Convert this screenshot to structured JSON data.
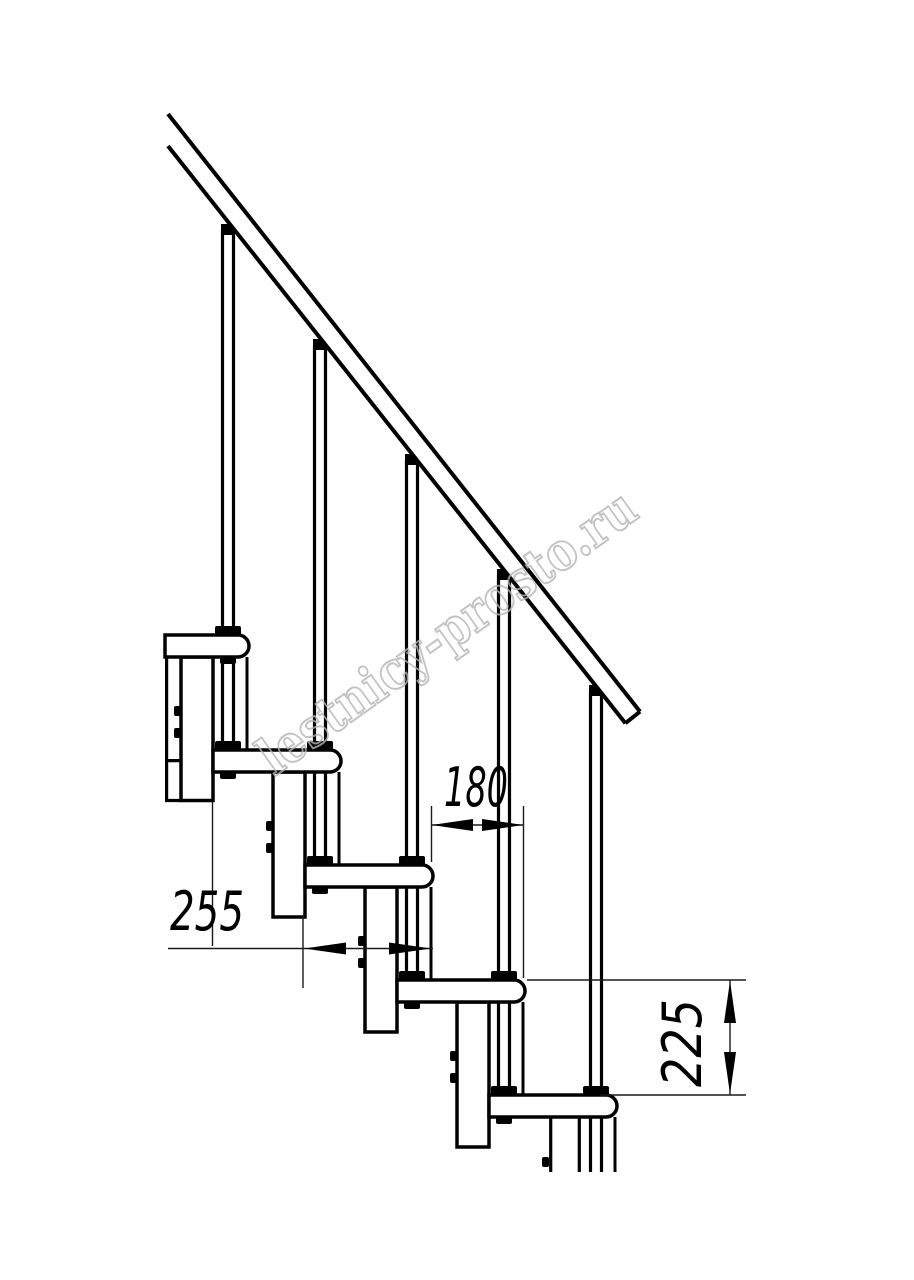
{
  "page": {
    "background": "#ffffff",
    "width_px": 914,
    "height_px": 1280
  },
  "drawing": {
    "kind": "modular-staircase-side-elevation",
    "line_color": "#000000",
    "treads_visible": 5,
    "balusters_visible": 5,
    "dimensions": {
      "run": "255",
      "offset": "180",
      "rise": "225"
    },
    "watermark": {
      "text": "lestnicy-prosto.ru",
      "color": "#b4b4b4",
      "angle_deg": -35.4
    }
  }
}
